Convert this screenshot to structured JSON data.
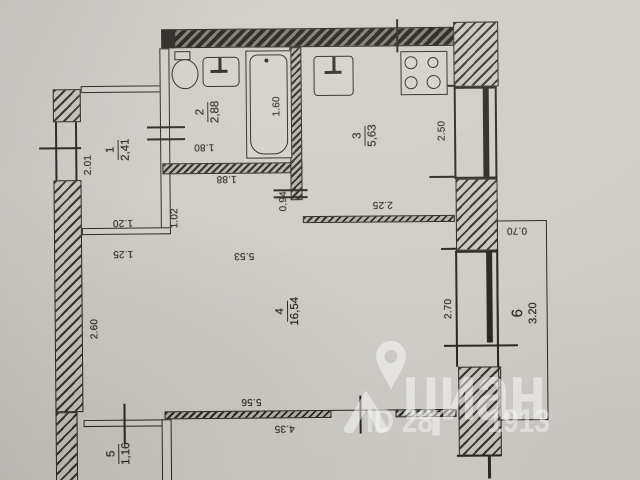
{
  "watermark": {
    "brand": "циан",
    "id_prefix": "ID 28",
    "id_suffix": "1913"
  },
  "rooms": [
    {
      "number": "1",
      "area": "2,41"
    },
    {
      "number": "2",
      "area": "2,88"
    },
    {
      "number": "3",
      "area": "5,63"
    },
    {
      "number": "4",
      "area": "16,54"
    },
    {
      "number": "5",
      "area": "1,16"
    },
    {
      "number": "6",
      "area": "3.20"
    }
  ],
  "dims": {
    "left_top": "2.01",
    "room1_width": "1.20",
    "room1_door": "1.02",
    "hall_left": "1.25",
    "left_bottom": "2.60",
    "bath_width": "1.80",
    "tub_length": "1.60",
    "bath_wall": "1.88",
    "kitchen_door": "0.94",
    "kitchen_width": "2.25",
    "kitchen_depth": "2.50",
    "room4_top": "5.53",
    "room4_depth": "2.70",
    "room4_width": "5.56",
    "room4_inner": "4.35",
    "balcony_depth": "0.70"
  },
  "fixtures": [
    "toilet",
    "washbasin",
    "bathtub",
    "kitchen-sink",
    "stove"
  ],
  "colors": {
    "paper": "#cfccc7",
    "ink": "#2b2823",
    "watermark": "rgba(255,255,255,0.5)"
  }
}
